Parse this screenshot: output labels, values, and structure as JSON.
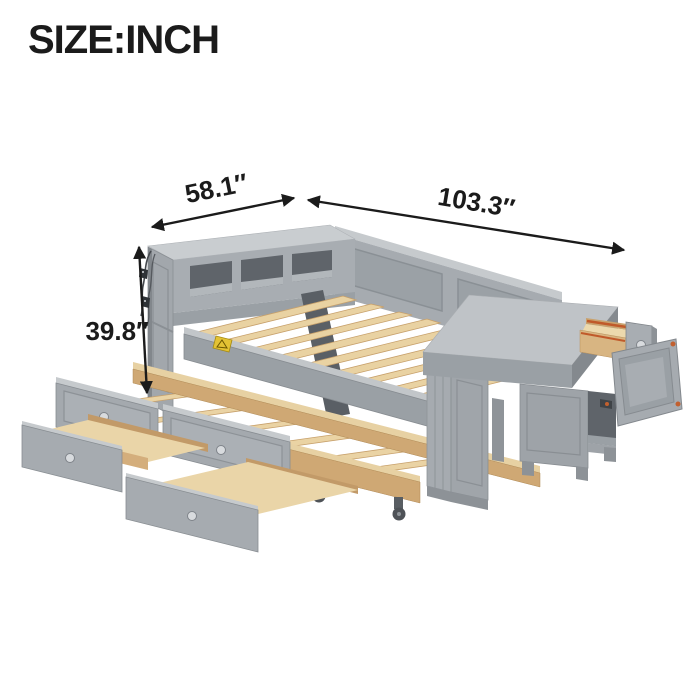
{
  "title": "SIZE:INCH",
  "dimensions": {
    "depth_label": "58.1″",
    "length_label": "103.3″",
    "height_label": "39.8″"
  },
  "colors": {
    "background": "#ffffff",
    "annotation_black": "#1b1b1b",
    "frame_gray_light": "#c7cbce",
    "frame_gray": "#a4a9ae",
    "frame_gray_dark": "#878c91",
    "cubby_interior": "#5f646a",
    "wood_light": "#e9d2a2",
    "wood_mid": "#d8b582",
    "wood_dark": "#c7a06b",
    "warning_sticker_yellow": "#e3c234",
    "drawer_slide_orange": "#c05a2a",
    "knob_silver": "#d8dbde"
  }
}
